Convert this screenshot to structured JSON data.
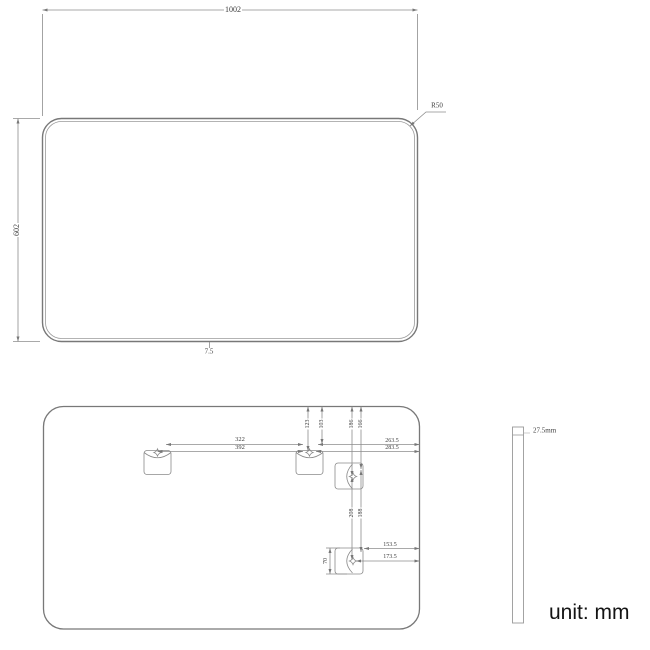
{
  "unit_note": "unit: mm",
  "front_view": {
    "width": "1002",
    "height": "602",
    "corner_radius": "R50",
    "bottom_edge": "7.5"
  },
  "back_view": {
    "hanger_span_inner": "322",
    "hanger_span_outer": "392",
    "hanger_top_offset_min": "103",
    "hanger_top_offset_max": "123",
    "hanger_right_offset_min": "263.5",
    "hanger_right_offset_max": "283.5",
    "side_hanger_top_offset_min": "166",
    "side_hanger_top_offset_max": "186",
    "side_hanger_span_max": "208",
    "side_hanger_span_min": "188",
    "hanger_height": "70",
    "bottom_hanger_right_offset_min": "153.5",
    "bottom_hanger_right_offset_max": "173.5"
  },
  "side_view": {
    "thickness": "27.5mm"
  }
}
